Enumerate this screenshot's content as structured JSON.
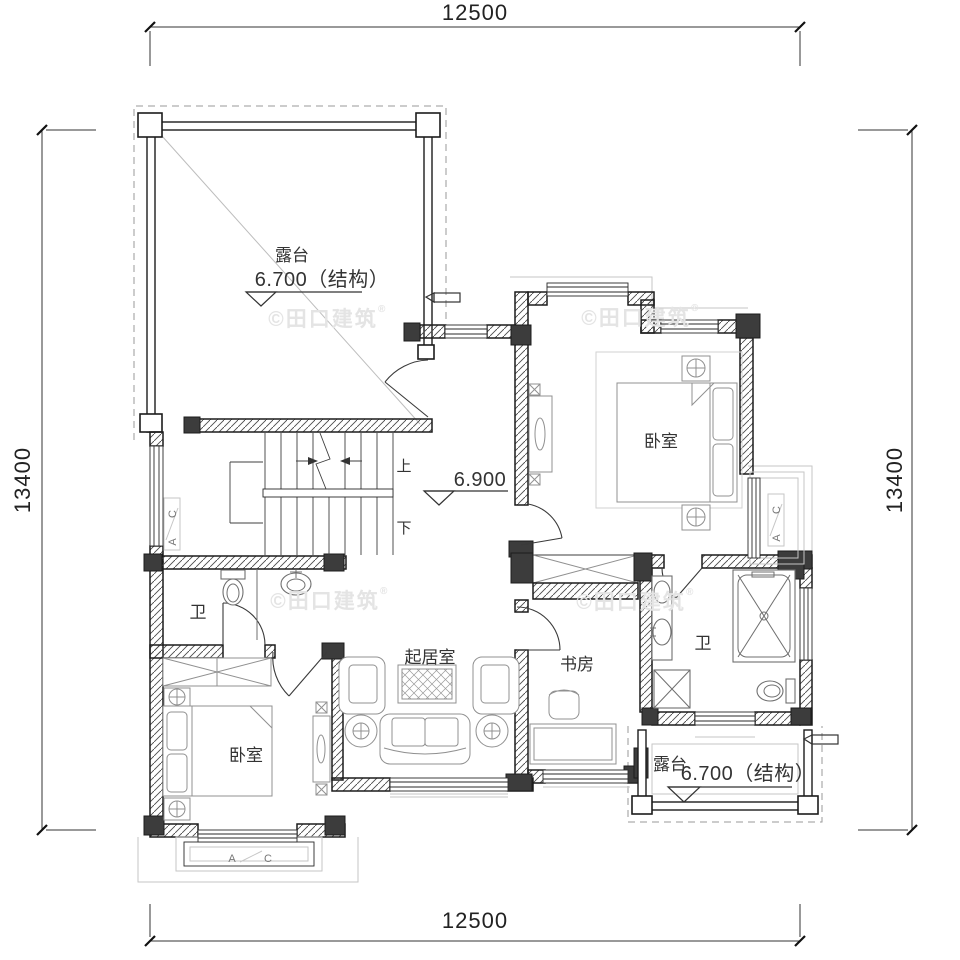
{
  "dimensions": {
    "top": "12500",
    "bottom": "12500",
    "left": "13400",
    "right": "13400"
  },
  "rooms": {
    "terrace_top": {
      "name": "露台",
      "elevation": "6.700（结构）"
    },
    "terrace_bottom": {
      "name": "露台",
      "elevation": "6.700（结构）"
    },
    "hall": {
      "elevation": "6.900"
    },
    "bedroom_right": {
      "name": "卧室"
    },
    "bedroom_left": {
      "name": "卧室"
    },
    "bath_left": {
      "name": "卫"
    },
    "bath_right": {
      "name": "卫"
    },
    "living": {
      "name": "起居室"
    },
    "study": {
      "name": "书房"
    }
  },
  "stairs": {
    "up": "上",
    "down": "下"
  },
  "window_tags": {
    "a": "A",
    "c": "C"
  },
  "watermark": {
    "text": "©田口建筑",
    "reg": "®"
  },
  "colors": {
    "wall": "#1c1c1c",
    "column": "#3c3c3c",
    "furniture": "#909090",
    "light_outline": "#c6c6c6",
    "watermark": "#e4e4e4",
    "text": "#2b2b2b"
  }
}
